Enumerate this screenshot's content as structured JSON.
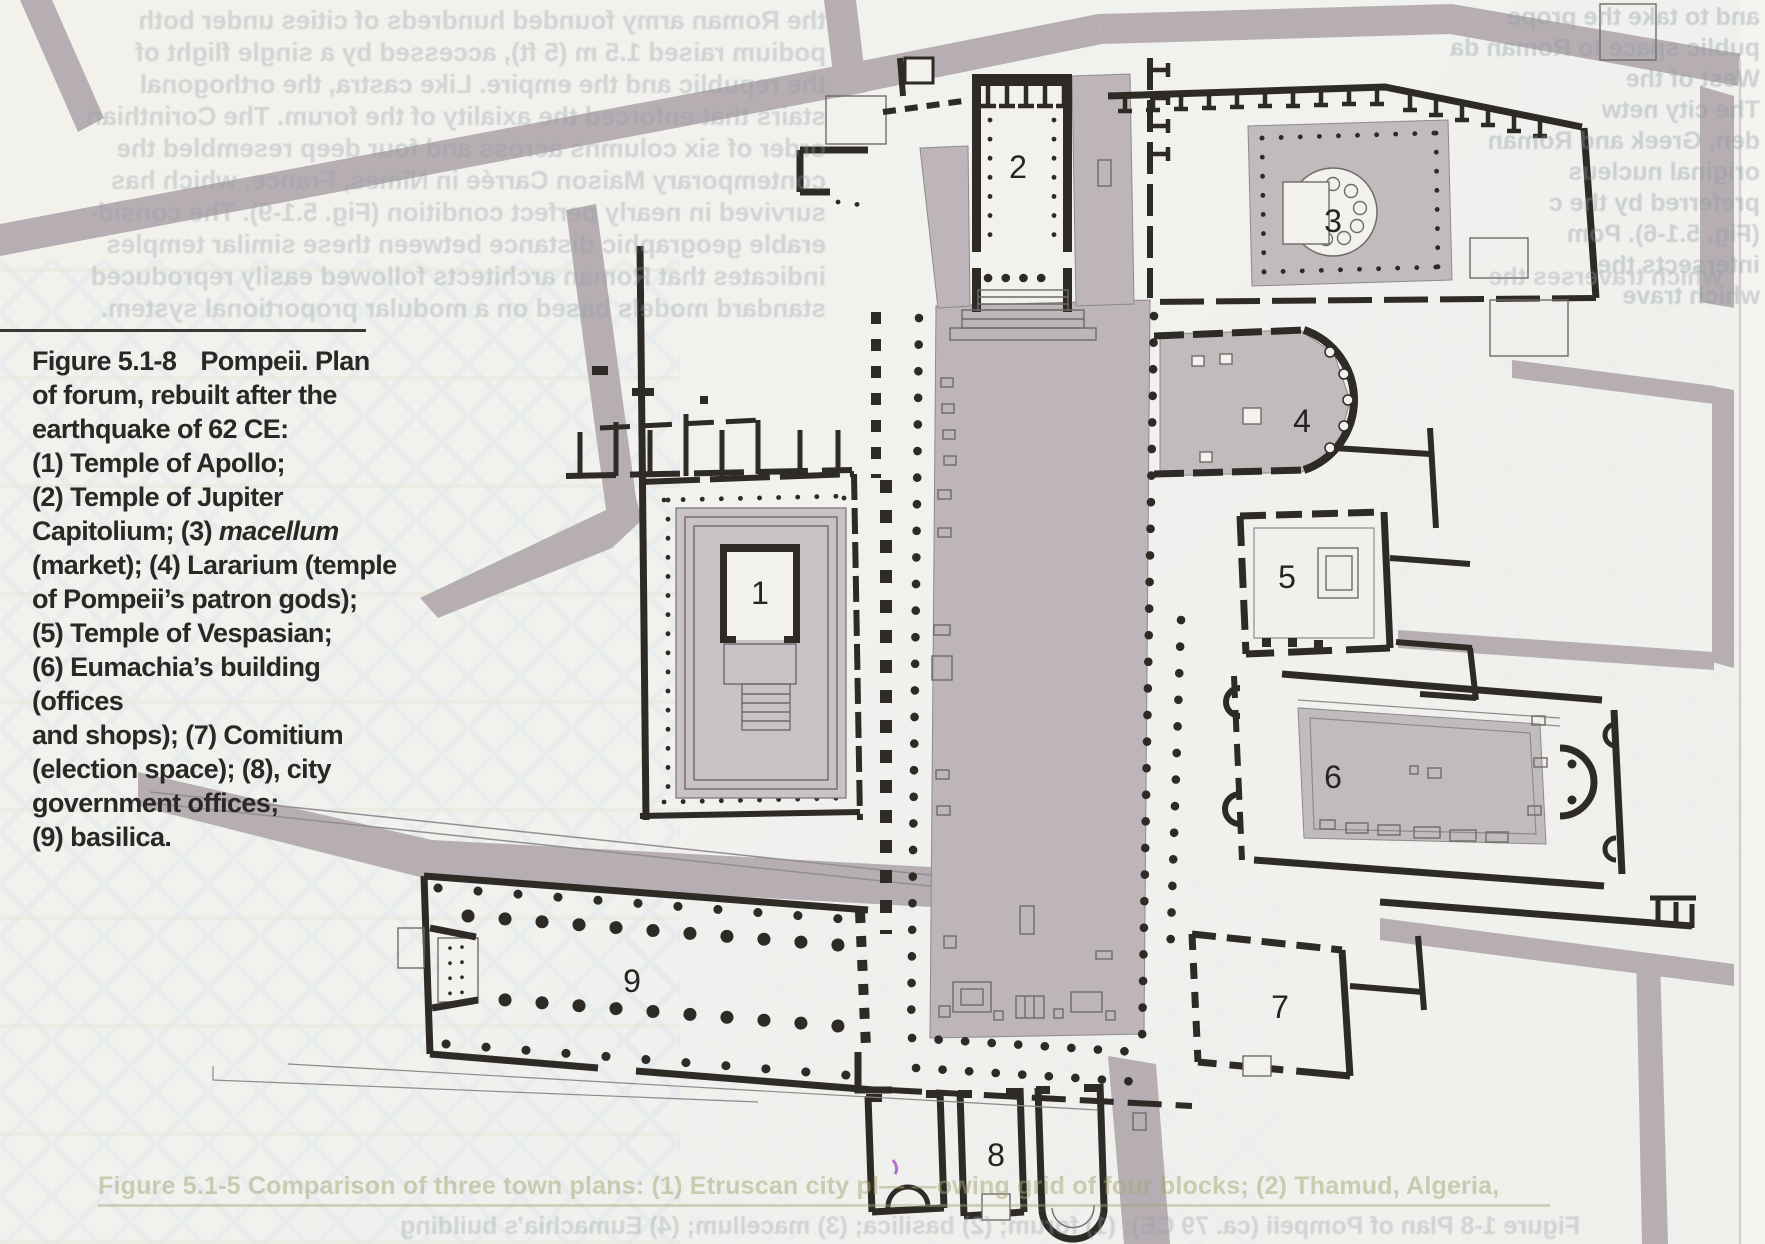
{
  "caption": {
    "fig_label": "Figure 5.1-8",
    "l1b": "Pompeii. Plan",
    "l2": "of forum, rebuilt after the",
    "l3": "earthquake of 62 CE:",
    "l4": "(1) Temple of Apollo;",
    "l5": "(2) Temple of Jupiter",
    "l6a": "Capitolium; (3) ",
    "l6b": "macellum",
    "l7": "(market); (4) Lararium (temple",
    "l8": "of Pompeii’s patron gods);",
    "l9": "(5) Temple of Vespasian;",
    "l10": "(6) Eumachia’s building (offices",
    "l11": "and shops); (7) Comitium",
    "l12": "(election space); (8), city",
    "l13": "government offices;",
    "l14": "(9) basilica."
  },
  "plan": {
    "labels": [
      "1",
      "2",
      "3",
      "4",
      "5",
      "6",
      "7",
      "8",
      "9"
    ]
  },
  "bleed_through": {
    "top_left": [
      "the Roman army founded hundreds of cities under both",
      "podium raised 1.5 m (5 ft), accessed by a single flight of",
      "the republic and the empire. Like castra, the orthogonal",
      "stairs that enforced the axiality of the forum. The Corinthian",
      "order of six columns across and four deep resembled the",
      "contemporary Maison Carrée in Nîmes, France, which has",
      "survived in nearly perfect condition (Fig. 5.1-9). The consid-",
      "erable geographic distance between these similar temples",
      "indicates that Roman architects followed easily reproduced",
      "standard models based on a modular proportional system."
    ],
    "top_right": [
      "and to take the prope",
      "public space to Roman da",
      "West of the",
      "The city netw",
      "den, Greek and Roman",
      "original nucleus",
      "preferred by the c",
      "(Fig. 5.1-6). Pom",
      "intersects the",
      "which trave"
    ],
    "right_fragment": [
      "which traverses the"
    ],
    "bottom_caption": "Figure 5.1-5   Comparison of three town plans: (1) Etruscan city pl—        —owing grid of four blocks; (2) Thamud, Algeria,",
    "bottom_mirrored": "Figure 1-8   Plan of Pompeii (ca. 79 CE): (1) forum; (2) basilica; (3) macellum; (4) Eumachia’s building"
  },
  "colors": {
    "paper": "#f1f0ed",
    "street": "#b6aeb2",
    "plaza": "#bdb5b9",
    "podium": "#c9c2c6",
    "wall": "#2e2b26"
  }
}
